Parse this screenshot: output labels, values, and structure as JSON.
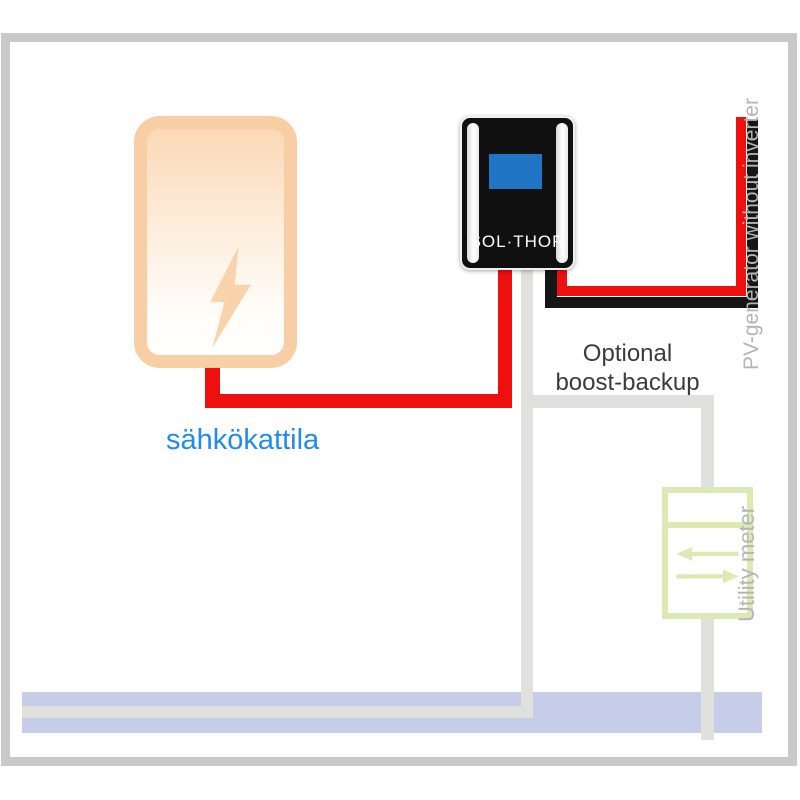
{
  "diagram": {
    "boiler": {
      "label": "sähkökattila",
      "icon": "lightning-bolt-icon"
    },
    "device": {
      "label": "SOL·THOR",
      "screen": "blue-display"
    },
    "boost": {
      "line1": "Optional",
      "line2": "boost-backup"
    },
    "pv": {
      "label": "PV-generator without inverter"
    },
    "meter": {
      "label": "Utility meter",
      "icon": "bidirectional-arrows-icon"
    }
  },
  "colors": {
    "frame_gray": "#c9c9c9",
    "wire_gray": "#e0e0dd",
    "wire_red": "#ee0f0f",
    "wire_black": "#161616",
    "grid_bus_blue": "#c5cde8",
    "boiler_orange_border": "#f8cfa4",
    "boiler_orange_fill": "#fbd9b6",
    "bolt_orange": "#f8d3ac",
    "device_black": "#101010",
    "screen_blue": "#2075c5",
    "meter_green": "#dde8b2",
    "label_blue": "#1f8ce8",
    "label_gray": "#b5b5b5",
    "label_dark": "#3b3b3b"
  }
}
